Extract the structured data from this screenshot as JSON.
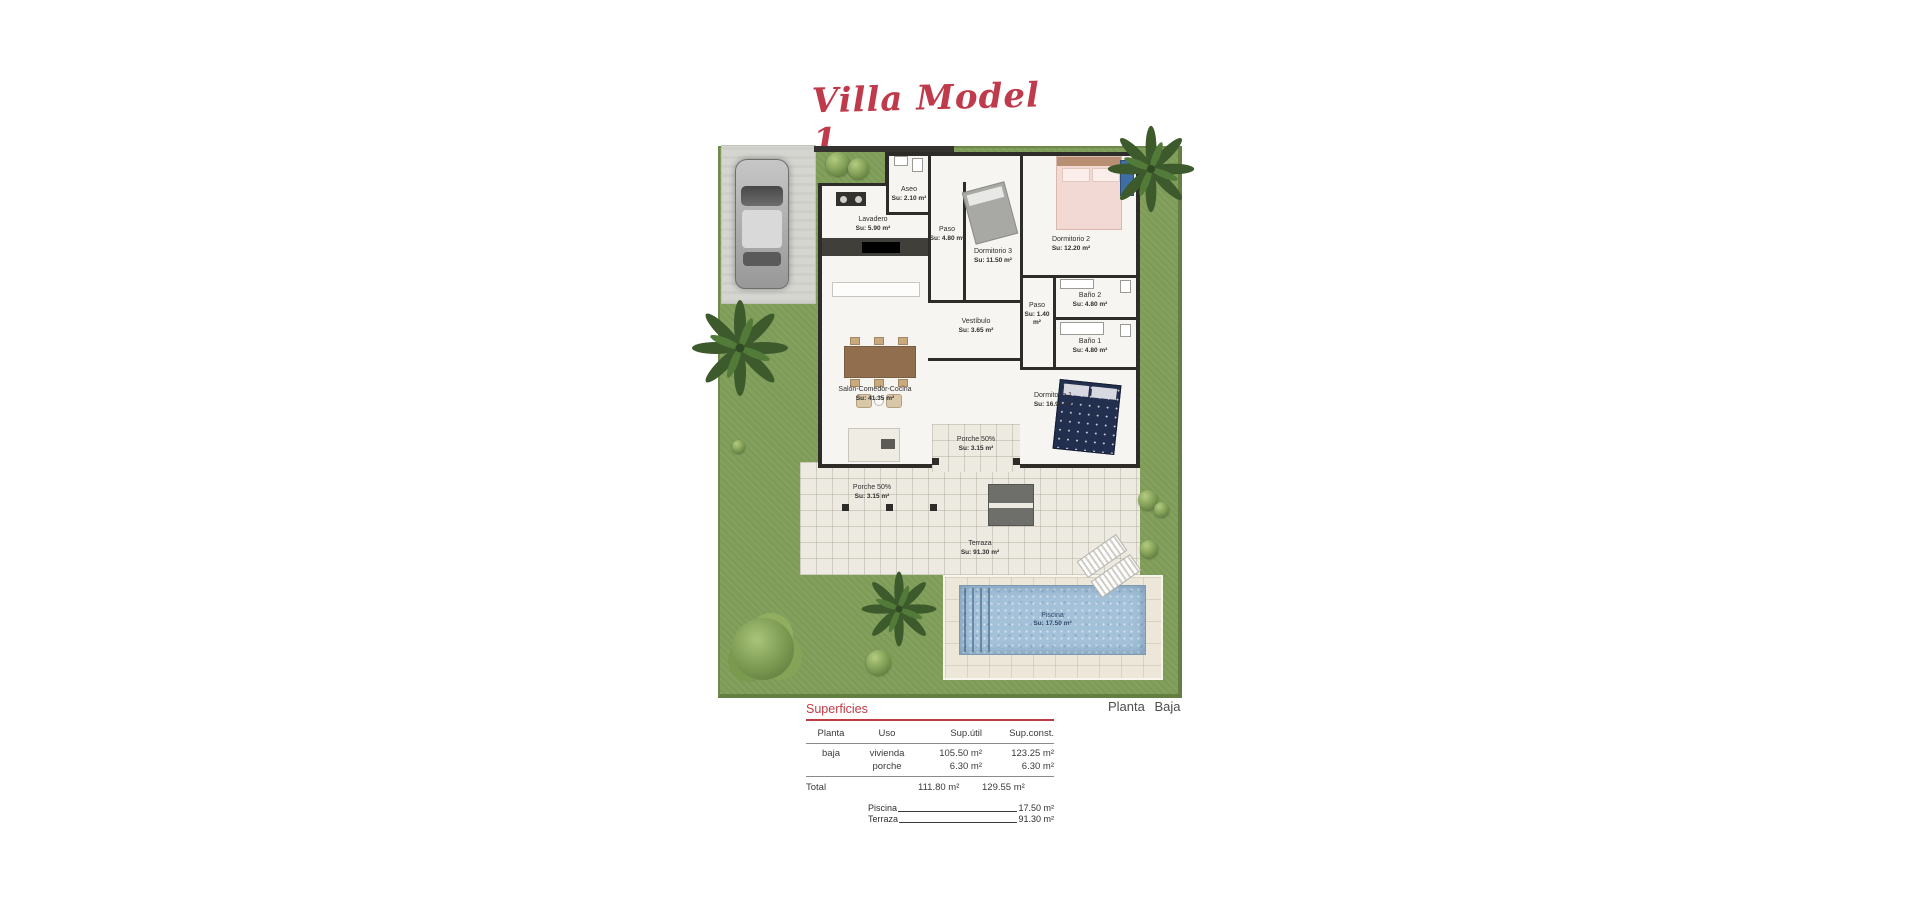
{
  "title": "Villa Model 1",
  "plan": {
    "floor_label": "Planta  Baja",
    "rooms": [
      {
        "name": "Lavadero",
        "area": "Su: 5.90 m²"
      },
      {
        "name": "Aseo",
        "area": "Su: 2.10 m²"
      },
      {
        "name": "Paso",
        "area": "Su: 4.80 m²"
      },
      {
        "name": "Dormitorio 3",
        "area": "Su: 11.50 m²"
      },
      {
        "name": "Dormitorio 2",
        "area": "Su: 12.20 m²"
      },
      {
        "name": "Baño 2",
        "area": "Su: 4.80 m²"
      },
      {
        "name": "Paso",
        "area": "Su: 1.40 m²"
      },
      {
        "name": "Baño 1",
        "area": "Su: 4.80 m²"
      },
      {
        "name": "Vestíbulo",
        "area": "Su: 3.65 m²"
      },
      {
        "name": "Salón-Comedor-Cocina",
        "area": "Su: 41.35 m²"
      },
      {
        "name": "Dormitorio 1",
        "area": "Su: 16.95 m²"
      },
      {
        "name": "Porche 50%",
        "area": "Su: 3.15 m²"
      },
      {
        "name": "Porche 50%",
        "area": "Su: 3.15 m²"
      },
      {
        "name": "Terraza",
        "area": "Su: 91.30 m²"
      },
      {
        "name": "Piscina",
        "area": "Su: 17.50 m²"
      }
    ]
  },
  "surfaces": {
    "heading": "Superficies",
    "columns": [
      "Planta",
      "Uso",
      "Sup.útil",
      "Sup.const."
    ],
    "rows": [
      {
        "planta": "baja",
        "uso": "vivienda",
        "util": "105.50 m²",
        "const": "123.25 m²"
      },
      {
        "planta": "",
        "uso": "porche",
        "util": "6.30 m²",
        "const": "6.30 m²"
      }
    ],
    "total": {
      "label": "Total",
      "util": "111.80 m²",
      "const": "129.55 m²"
    }
  },
  "notes": [
    {
      "label": "Piscina",
      "value": "17.50 m²"
    },
    {
      "label": "Terraza",
      "value": "91.30 m²"
    }
  ],
  "colors": {
    "accent_red": "#bf3a4a",
    "garden_green": "#7e9c57",
    "pool_blue": "#a4c1da",
    "terrace_beige": "#edeae1",
    "wall_dark": "#2e2c29"
  }
}
